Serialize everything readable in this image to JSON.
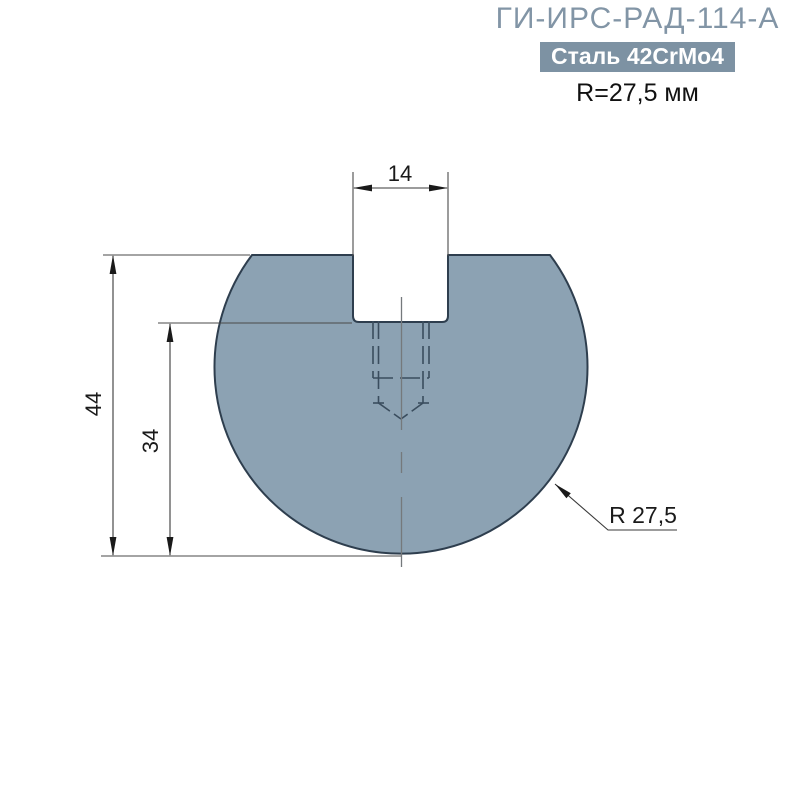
{
  "header": {
    "title": "ГИ-ИРС-РАД-114-А",
    "material_badge": "Сталь 42CrMo4",
    "radius_note": "R=27,5 мм"
  },
  "drawing": {
    "dim_top_width": "14",
    "dim_total_height": "44",
    "dim_shoulder_height": "34",
    "radius_callout": "R 27,5"
  },
  "colors": {
    "body_fill": "#8CA2B3",
    "body_outline": "#2E3E4E",
    "hidden_line": "#3A4D5E",
    "centerline": "#75797C",
    "dimension_line": "#3A3A3A",
    "dimension_text": "#1A1A1A",
    "title_text": "#8295A6",
    "badge_bg": "#7D92A3",
    "badge_text": "#FFFFFF"
  }
}
